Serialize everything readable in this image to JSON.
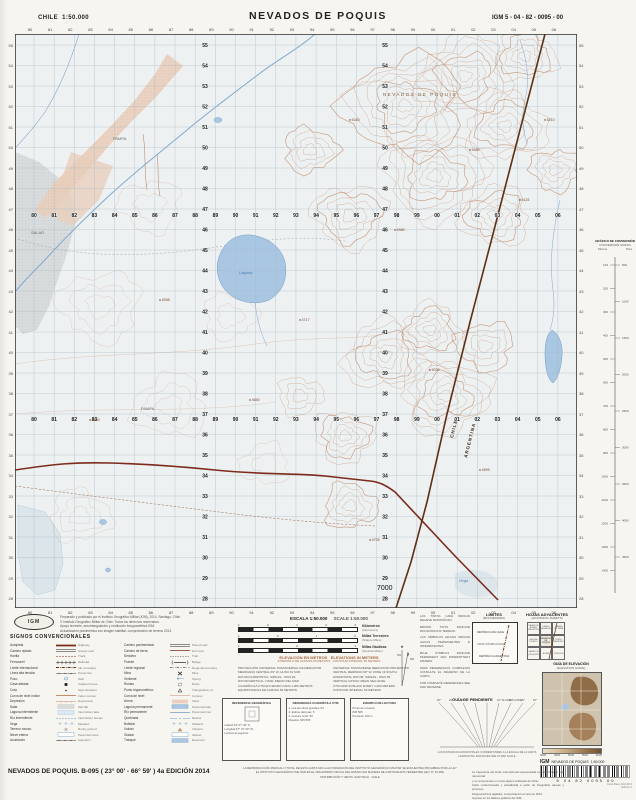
{
  "header": {
    "country": "CHILE",
    "scale": "1:50.000",
    "title": "NEVADOS DE POQUIS",
    "sheet_code": "IGM 5 - 04 - 82 - 0095 - 00"
  },
  "map": {
    "easting_labels": [
      "80",
      "81",
      "82",
      "83",
      "84",
      "85",
      "86",
      "87",
      "88",
      "89",
      "90",
      "91",
      "92",
      "93",
      "94",
      "95",
      "96",
      "97",
      "98",
      "99",
      "00",
      "01",
      "02",
      "03",
      "04",
      "05",
      "06"
    ],
    "northing_labels": [
      "55",
      "54",
      "53",
      "52",
      "51",
      "50",
      "49",
      "48",
      "47",
      "46",
      "45",
      "44",
      "43",
      "42",
      "41",
      "40",
      "39",
      "38",
      "37",
      "36",
      "35",
      "34",
      "33",
      "32",
      "31",
      "30",
      "29",
      "28"
    ],
    "grid_origin_label": "7000",
    "boundary": {
      "left": "CHILE",
      "right": "ARGENTINA"
    },
    "place_labels": [
      {
        "text": "NEVADOS DE POQUIS",
        "x": 368,
        "y": 62,
        "cls": "mtn"
      },
      {
        "text": "PAMPA",
        "x": 98,
        "y": 106,
        "cls": "pampa"
      },
      {
        "text": "Laguna",
        "x": 224,
        "y": 240,
        "cls": "lag"
      },
      {
        "text": "SALAR",
        "x": 16,
        "y": 200,
        "cls": "pampa"
      },
      {
        "text": "PAMPA",
        "x": 126,
        "y": 376,
        "cls": "pampa"
      },
      {
        "text": "Vega",
        "x": 444,
        "y": 548,
        "cls": "lag"
      }
    ],
    "spot_heights": [
      {
        "x": 335,
        "y": 86,
        "v": "5340"
      },
      {
        "x": 455,
        "y": 116,
        "v": "5480"
      },
      {
        "x": 505,
        "y": 166,
        "v": "5115"
      },
      {
        "x": 380,
        "y": 196,
        "v": "4980"
      },
      {
        "x": 285,
        "y": 286,
        "v": "4717"
      },
      {
        "x": 235,
        "y": 366,
        "v": "4650"
      },
      {
        "x": 415,
        "y": 336,
        "v": "5030"
      },
      {
        "x": 465,
        "y": 436,
        "v": "4895"
      },
      {
        "x": 145,
        "y": 266,
        "v": "4598"
      },
      {
        "x": 75,
        "y": 386,
        "v": "4560"
      },
      {
        "x": 530,
        "y": 86,
        "v": "5210"
      },
      {
        "x": 355,
        "y": 506,
        "v": "4705"
      }
    ]
  },
  "conversion": {
    "title": "GRÁFICO DE CONVERSIÓN",
    "subtitle": "CONVERSION GRAPH",
    "left_unit": "Metros",
    "right_unit": "Pies",
    "left_values": [
      "100",
      "200",
      "300",
      "400",
      "500",
      "600",
      "700",
      "800",
      "900",
      "1000",
      "1100",
      "1200",
      "1300",
      "1400"
    ],
    "right_values": [
      "500",
      "1000",
      "1500",
      "2000",
      "2500",
      "3000",
      "3500",
      "4000",
      "4500"
    ]
  },
  "scale_block": {
    "title_es": "ESCALA 1:50.000",
    "title_en": "SCALE 1:50.000",
    "bars": [
      {
        "label_es": "Kilómetros",
        "label_en": "(Kilometers)",
        "ticks": [
          "1",
          "0",
          "1",
          "2",
          "3"
        ]
      },
      {
        "label_es": "Millas Terrestres",
        "label_en": "(Statute Miles)",
        "ticks": [
          "1",
          "0",
          "1",
          "2"
        ]
      },
      {
        "label_es": "Millas Náuticas",
        "label_en": "(Nautical Miles)",
        "ticks": [
          "1",
          "0",
          "1"
        ]
      }
    ],
    "elev_es": "ELEVACIÓN EN METROS",
    "elev_en": "ELEVATIONS IN METERS",
    "interval_es": "INTERVALO DE CURVAS 50 METROS",
    "interval_en": "CONTOUR INTERVAL 50 METERS"
  },
  "credits": {
    "lines": [
      "Preparado y publicado por el Instituto Geográfico Militar (IGM), 2014, Santiago, Chile.",
      "© Instituto Geográfico Militar de Chile. Todos los derechos reservados.",
      "Apoyo terrestre, aerotriangulación y restitución fotogramétrica IGM.",
      "Actualización planimétrica con imagen satelital, comprobación de terreno 2013."
    ]
  },
  "legend": {
    "title": "SIGNOS CONVENCIONALES",
    "items": [
      {
        "e": "Autopista",
        "n": "Highway",
        "s": "road2"
      },
      {
        "e": "Camino pavimentado",
        "n": "Paved road",
        "s": "road1"
      },
      {
        "e": "Camino ripiado",
        "n": "Gravel road",
        "s": "road1"
      },
      {
        "e": "Camino de tierra",
        "n": "Dirt road",
        "s": "track"
      },
      {
        "e": "Huella",
        "n": "Track",
        "s": "trackd"
      },
      {
        "e": "Sendero",
        "n": "Trail",
        "s": "trail"
      },
      {
        "e": "Ferrocarril",
        "n": "Railroad",
        "s": "rail"
      },
      {
        "e": "Puente",
        "n": "Bridge",
        "s": "bridge"
      },
      {
        "e": "Límite internacional",
        "n": "Intl. boundary",
        "s": "bound"
      },
      {
        "e": "Límite regional",
        "n": "Regional boundary",
        "s": "bound2"
      },
      {
        "e": "Línea alta tensión",
        "n": "Power line",
        "s": "power"
      },
      {
        "e": "Mina",
        "n": "Mine",
        "s": "mine"
      },
      {
        "e": "Pozo",
        "n": "Well",
        "s": "well"
      },
      {
        "e": "Vertiente",
        "n": "Spring",
        "s": "spring"
      },
      {
        "e": "Casa aislada",
        "n": "Isolated house",
        "s": "house"
      },
      {
        "e": "Ruinas",
        "n": "Ruins",
        "s": "ruin"
      },
      {
        "e": "Cota",
        "n": "Spot elevation",
        "s": "dot"
      },
      {
        "e": "Punto trigonométrico",
        "n": "Triangulation pt.",
        "s": "tri"
      },
      {
        "e": "Curva de nivel índice",
        "n": "Index contour",
        "s": "contourI"
      },
      {
        "e": "Curva de nivel",
        "n": "Contour",
        "s": "contour"
      },
      {
        "e": "Depresión",
        "n": "Depression",
        "s": "depr"
      },
      {
        "e": "Arena",
        "n": "Sand",
        "s": "sand"
      },
      {
        "e": "Salar",
        "n": "Salt flat",
        "s": "salar"
      },
      {
        "e": "Laguna permanente",
        "n": "Perennial lake",
        "s": "lake"
      },
      {
        "e": "Laguna intermitente",
        "n": "Intermittent lake",
        "s": "lakeI"
      },
      {
        "e": "Río permanente",
        "n": "Perennial river",
        "s": "water"
      },
      {
        "e": "Río intermitente",
        "n": "Intermittent stream",
        "s": "waterI"
      },
      {
        "e": "Quebrada",
        "n": "Ravine",
        "s": "queb"
      },
      {
        "e": "Vega",
        "n": "Meadow",
        "s": "marsh"
      },
      {
        "e": "Bofedal",
        "n": "Wetland",
        "s": "marsh"
      },
      {
        "e": "Terreno rocoso",
        "n": "Rocky ground",
        "s": "rock"
      },
      {
        "e": "Volcán",
        "n": "Volcano",
        "s": "volc"
      },
      {
        "e": "Nieve eterna",
        "n": "Perennial snow",
        "s": "snow"
      },
      {
        "e": "Glaciar",
        "n": "Glacier",
        "s": "snow"
      },
      {
        "e": "Acueducto",
        "n": "Aqueduct",
        "s": "power"
      },
      {
        "e": "Tranque",
        "n": "Reservoir",
        "s": "lake"
      }
    ]
  },
  "datum_notes": [
    "PROYECCIÓN UNIVERSAL TRANSVERSAL DE MERCATOR",
    "MERIDIANO CENTRAL 69° W, HUSO 19 SUR",
    "DATUM HORIZONTAL: SIRGAS - WGS 84",
    "DATUM VERTICAL: NIVEL MEDIO DEL MAR",
    "CUADRÍCULA UTM EN NEGRO CADA 1.000 METROS",
    "EQUIDISTANCIA DE CURVAS 50 METROS",
    "UNIVERSAL TRANSVERSE MERCATOR PROJECTION",
    "CENTRAL MERIDIAN 69° W, ZONE 19 SOUTH",
    "HORIZONTAL DATUM: SIRGAS - WGS 84",
    "VERTICAL DATUM: MEAN SEA LEVEL",
    "UTM GRID IN BLACK EVERY 1,000 METERS",
    "CONTOUR INTERVAL 50 METERS"
  ],
  "declination": {
    "ng": "NG",
    "nm": "NM"
  },
  "utm_boxes": [
    {
      "title": "REFERENCIA GEOGRÁFICA",
      "lines": [
        "Latitud 23° 07' 30\" S",
        "Longitud 67° 07' 30\" W",
        "Lectura al segundo"
      ]
    },
    {
      "title": "REFERENCIA CUADRÍCULA UTM",
      "lines": [
        "1. Lea las cifras grandes: 84",
        "2. Estime décimas: 5",
        "3. Lectura norte: 50",
        "Muestra: 845 505"
      ]
    },
    {
      "title": "EJEMPLO DE LECTURA",
      "lines": [
        "Punto de muestra",
        "845 505",
        "Precisión 100 m"
      ]
    }
  ],
  "right_notes": [
    "LAS TINTAS CAFÉ INDICAN RELIEVE MONTAÑOSO.",
    "BROWN TINTS INDICATE MOUNTAINOUS TERRAIN.",
    "LOS SÍMBOLOS AZULES INDICAN AGUAS PERMANENTES E INTERMITENTES.",
    "BLUE SYMBOLS INDICATE PERMANENT AND INTERMITTENT WATERS.",
    "PARA REFERENCIAS COMPLETAS CONSULTE EL REVERSO DE LA CARTA.",
    "FOR COMPLETE REFERENCES SEE MAP REVERSE."
  ],
  "limites": {
    "title": "LÍMITES",
    "subtitle": "(BOUNDARIES)",
    "labels": [
      "REPÚBLICA DE CHILE",
      "LÍMITE INTERNACIONAL",
      "REPÚBLICA ARGENTINA"
    ]
  },
  "hojas": {
    "title": "HOJAS ADYACENTES",
    "subtitle": "(ADJOINING SHEETS)",
    "cells": [
      "SALAR DE AGUAS CALIENTES",
      "CERRO MEDANOSO",
      "SIERRA DE TAIRA",
      "LAGUNA TUYAJTO",
      "NEVADOS DE POQUIS",
      "CERRO ZAPALERI",
      "SALAR DE QUISQUIRO",
      "ALITAR",
      "PURIFICA"
    ]
  },
  "slope_guide": {
    "title_es": "GUÍA DE PENDIENTE",
    "title_en": "SLOPE GUIDE",
    "labels": [
      "45°",
      "30°",
      "20°",
      "10°",
      "5°",
      "10°",
      "20°",
      "30°",
      "45°"
    ],
    "notes": [
      "LAS DISTANCIAS HORIZONTALES CORRESPONDEN A LA ESCALA DE LA CARTA",
      "HORIZONTAL DISTANCES ARE AT MAP SCALE"
    ]
  },
  "elevation_guide": {
    "title_es": "GUÍA DE ELEVACIÓN",
    "title_en": "(ELEVATION GUIDE)",
    "unit": "Metros",
    "bar_labels": [
      "4000",
      "4500",
      "5000",
      "5500",
      "6000"
    ]
  },
  "barcode": {
    "org": "IGM",
    "name": "NEVADOS DE POQUIS",
    "scale": "1:50.000",
    "digits": [
      "5",
      "04",
      "82",
      "0095",
      "00"
    ],
    "note_lines": [
      "Carta Base IGM 2014",
      "Edición 4"
    ]
  },
  "footer": {
    "title": "NEVADOS DE POQUIS. B-095 ( 23° 00' - 66° 59' ) 4a EDICIÓN 2014",
    "center_lines": [
      "LA REPRODUCCIÓN PARCIAL O TOTAL DE ESTA CARTA SIN LA AUTORIZACIÓN DEL INSTITUTO GEOGRÁFICO MILITAR SE ENCUENTRA PROHIBIDA POR LA LEY",
      "EL INSTITUTO GEOGRÁFICO MILITAR ES EL ORGANISMO OFICIAL DEL ESTADO EN MATERIA DE CARTOGRAFÍA TERRESTRE (LEY N° 15.284)",
      "DISTRIBUCIÓN Y VENTA: SANTIAGO - CHILE"
    ],
    "right_lines": [
      "La trayectoria del límite internacional representada en esta carta es sólo referencial",
      "y no compromete en modo alguno al Estado de Chile.",
      "Carta confeccionada y actualizada a partir de fotografías aéreas y procesos",
      "fotogramétricos digitales, comprobación en terreno 2013.",
      "Impresa en los talleres gráficos del IGM."
    ]
  }
}
